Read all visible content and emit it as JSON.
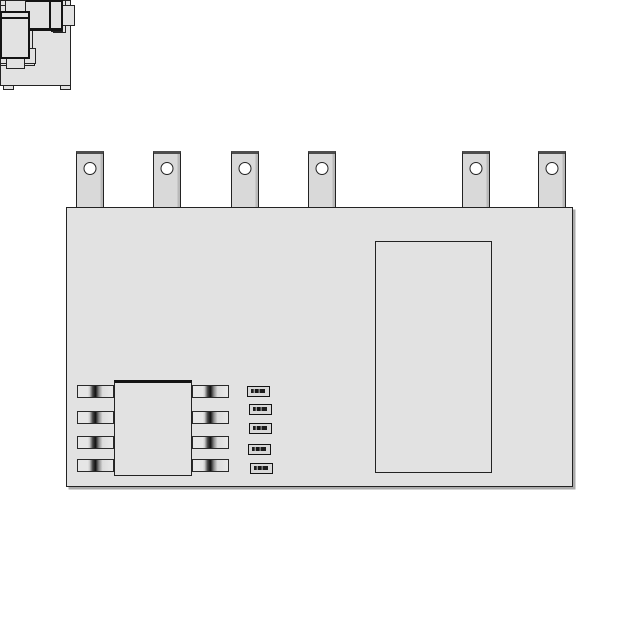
{
  "palette": {
    "background": "#ffffff",
    "board_fill": "#e2e2e2",
    "outline": "#232323",
    "outline_dark": "#141414",
    "pin_fill": "#d9d9d9",
    "pin_top": "#4e4e4e",
    "hole_fill": "#ffffff",
    "shadow": "#aaaaaa"
  },
  "board": {
    "x": 66,
    "y": 207,
    "w": 507,
    "h": 280
  },
  "pin_style": {
    "y": 151,
    "w": 28,
    "h": 57,
    "hole_d": 13
  },
  "pins": [
    {
      "id": "module-pin-1",
      "x": 76
    },
    {
      "id": "module-pin-2",
      "x": 153
    },
    {
      "id": "module-pin-3",
      "x": 231
    },
    {
      "id": "module-pin-4",
      "x": 308
    },
    {
      "id": "module-pin-5",
      "x": 462
    },
    {
      "id": "module-pin-6",
      "x": 538
    }
  ],
  "components": [
    {
      "name": "corner-pad-component",
      "type": "padblock",
      "x": 87,
      "y": 217,
      "w": 71,
      "h": 91,
      "body_top": 6,
      "body_h": 80,
      "tab_w": 11,
      "tab_h": 10
    },
    {
      "name": "capacitor-c1",
      "type": "vcap",
      "x": 177,
      "y": 263,
      "w": 31,
      "h": 62,
      "band": 11
    },
    {
      "name": "capacitor-c2",
      "type": "vcap",
      "x": 222,
      "y": 224,
      "w": 35,
      "h": 66,
      "band": 17
    },
    {
      "name": "capacitor-c3",
      "type": "vcap",
      "x": 273,
      "y": 227,
      "w": 29,
      "h": 61,
      "band": 12
    },
    {
      "name": "capacitor-c4",
      "type": "vcap",
      "x": 296,
      "y": 323,
      "w": 36,
      "h": 64,
      "band": 16
    },
    {
      "name": "capacitor-c5",
      "type": "vcap",
      "x": 343,
      "y": 338,
      "w": 27,
      "h": 44,
      "band": 11
    },
    {
      "name": "capacitor-c6",
      "type": "vcap",
      "x": 495,
      "y": 368,
      "w": 25,
      "h": 44,
      "band": 11
    },
    {
      "name": "capacitor-c7",
      "type": "hcap",
      "x": 238,
      "y": 346,
      "w": 43,
      "h": 27,
      "band": 10
    },
    {
      "name": "capacitor-c8",
      "type": "hcap",
      "x": 307,
      "y": 409,
      "w": 43,
      "h": 27,
      "band": 10
    },
    {
      "name": "capacitor-c9",
      "type": "hcap",
      "x": 498,
      "y": 228,
      "w": 66,
      "h": 33,
      "band": 13
    },
    {
      "name": "capacitor-c10",
      "type": "hcap",
      "x": 506,
      "y": 282,
      "w": 43,
      "h": 26,
      "band": 10
    },
    {
      "name": "capacitor-c11",
      "type": "hcap",
      "x": 500,
      "y": 439,
      "w": 63,
      "h": 32,
      "band": 12
    },
    {
      "name": "diode-d1",
      "type": "melf",
      "x": 98,
      "y": 333,
      "tab_w": 10,
      "tab_h": 21,
      "body_w": 52,
      "body_h": 31,
      "band_offset": 10
    },
    {
      "name": "diode-d2",
      "type": "melf",
      "x": 289,
      "y": 449,
      "tab_w": 12,
      "tab_h": 21,
      "body_w": 51,
      "body_h": 30,
      "band_offset": 10
    },
    {
      "name": "soic8-ic-u1",
      "type": "ic",
      "x": 114,
      "y": 380,
      "w": 78,
      "h": 96,
      "pin_w": 37,
      "pin_h": 13,
      "left_x": 77,
      "right_x": 192,
      "rows": [
        385,
        411,
        436,
        459
      ]
    },
    {
      "name": "chip-resistor-r1",
      "type": "resistor",
      "x": 247,
      "y": 386,
      "w": 23,
      "h": 11
    },
    {
      "name": "chip-resistor-r2",
      "type": "resistor",
      "x": 249,
      "y": 404,
      "w": 23,
      "h": 11
    },
    {
      "name": "chip-resistor-r3",
      "type": "resistor",
      "x": 249,
      "y": 423,
      "w": 23,
      "h": 11
    },
    {
      "name": "chip-resistor-r4",
      "type": "resistor",
      "x": 248,
      "y": 444,
      "w": 23,
      "h": 11
    },
    {
      "name": "chip-resistor-r5",
      "type": "resistor",
      "x": 250,
      "y": 463,
      "w": 23,
      "h": 11
    },
    {
      "name": "large-module-block",
      "type": "rect",
      "x": 375,
      "y": 241,
      "w": 117,
      "h": 232
    },
    {
      "name": "electrolytic-capacitor",
      "type": "ecap",
      "x": 532,
      "y": 355,
      "body_w": 30,
      "body_h": 48,
      "body_top": 11,
      "top_tab": {
        "dx": 5,
        "w": 21,
        "h": 12
      },
      "bot_tab": {
        "dx": 6,
        "w": 19,
        "h": 10
      }
    }
  ]
}
